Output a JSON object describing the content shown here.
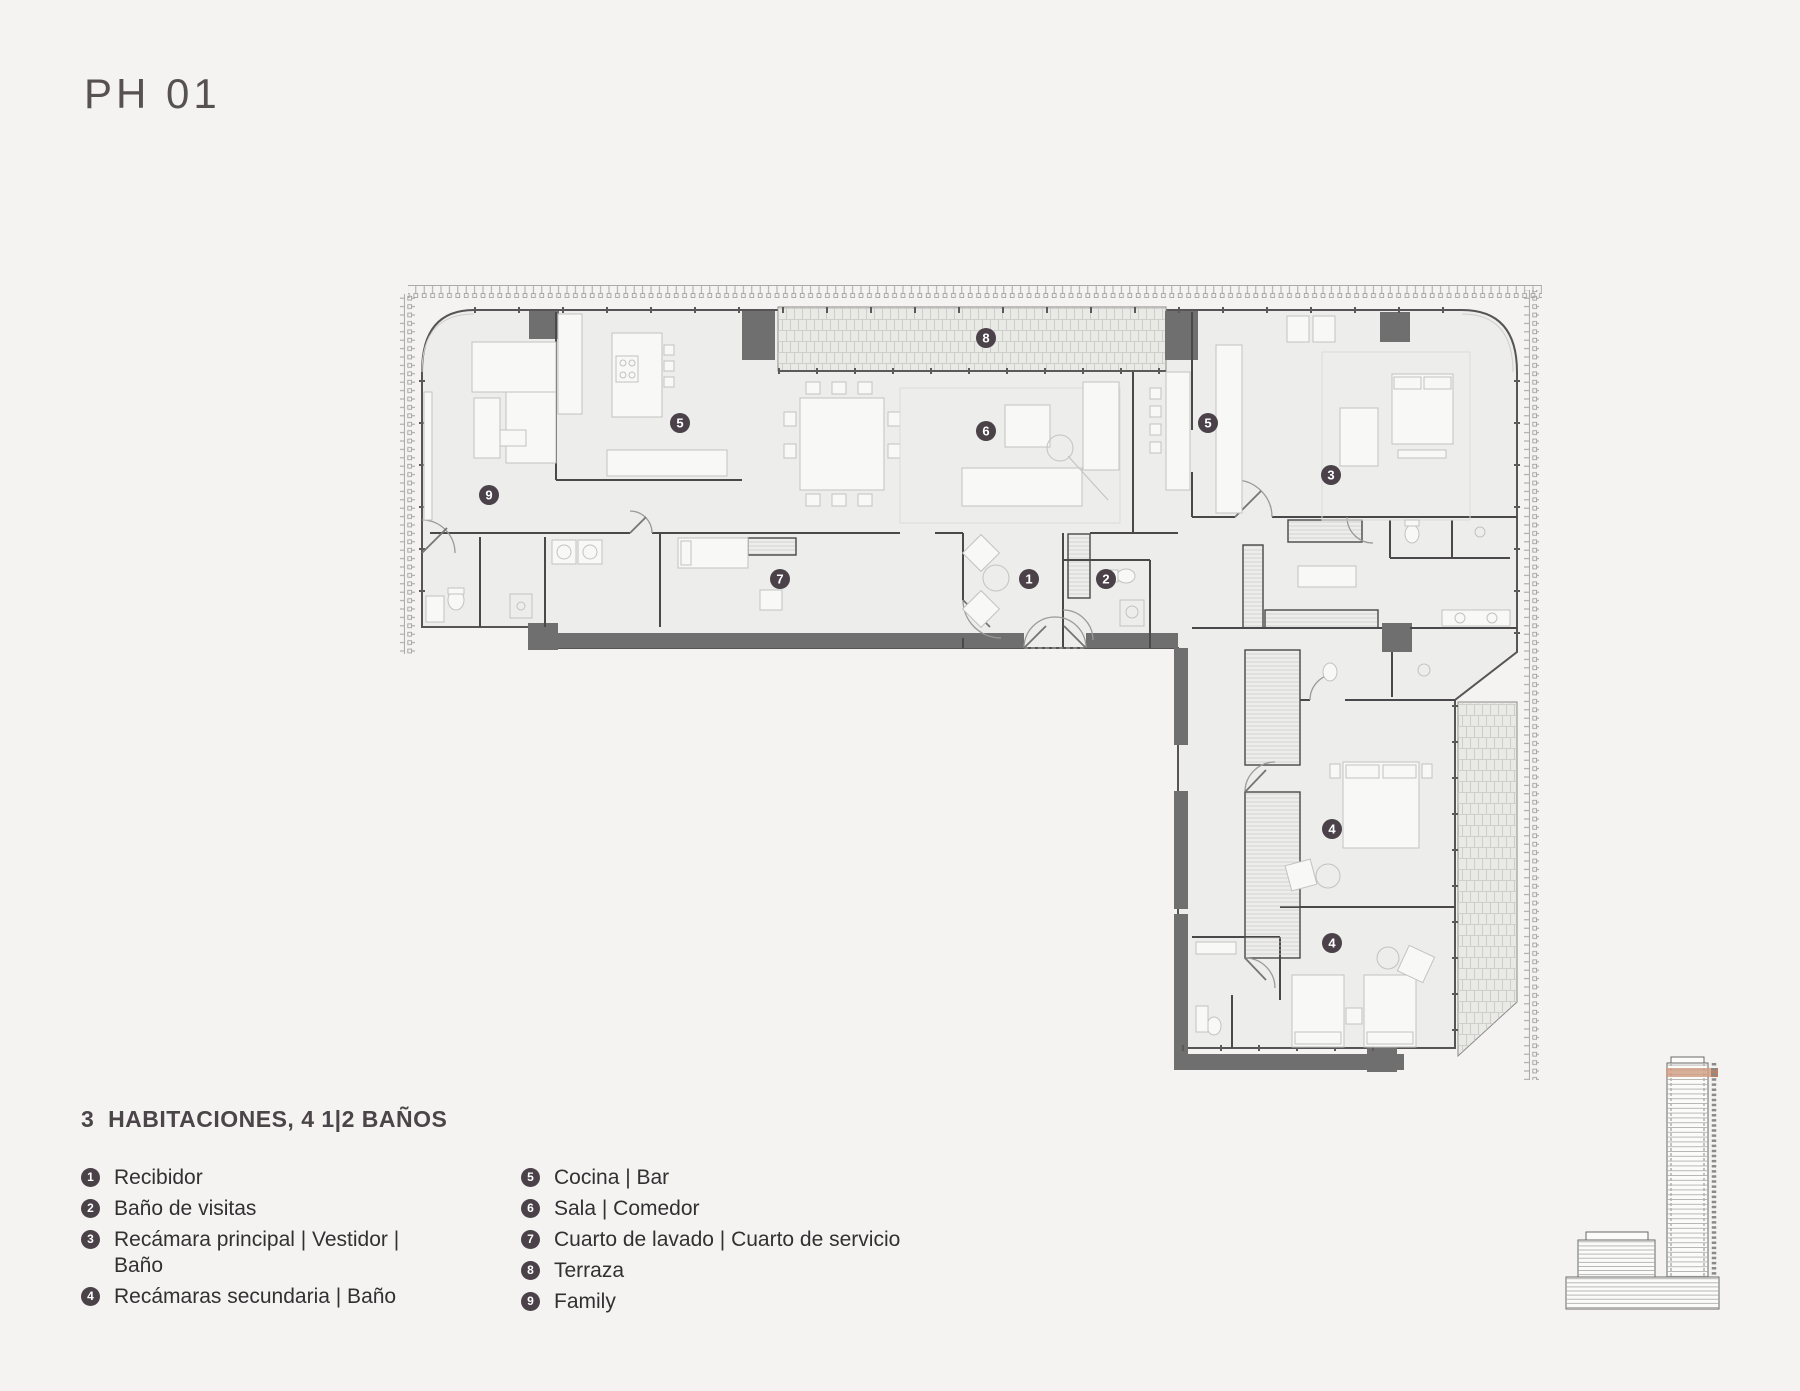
{
  "title": "PH 01",
  "legend": {
    "heading": "3  HABITACIONES, 4 1|2 BAÑOS",
    "columns": [
      {
        "items": [
          {
            "num": "1",
            "label": "Recibidor"
          },
          {
            "num": "2",
            "label": "Baño de visitas"
          },
          {
            "num": "3",
            "label": "Recámara principal | Vestidor | Baño"
          },
          {
            "num": "4",
            "label": "Recámaras secundaria | Baño"
          }
        ]
      },
      {
        "items": [
          {
            "num": "5",
            "label": "Cocina | Bar"
          },
          {
            "num": "6",
            "label": "Sala | Comedor"
          },
          {
            "num": "7",
            "label": "Cuarto de lavado | Cuarto de servicio"
          },
          {
            "num": "8",
            "label": "Terraza"
          },
          {
            "num": "9",
            "label": "Family"
          }
        ]
      }
    ]
  },
  "plan": {
    "markers": [
      {
        "label": "1",
        "room": "Recibidor"
      },
      {
        "label": "2",
        "room": "Baño de visitas"
      },
      {
        "label": "3",
        "room": "Recámara principal"
      },
      {
        "label": "4",
        "room": "Recámara secundaria"
      },
      {
        "label": "4",
        "room": "Recámara secundaria"
      },
      {
        "label": "5",
        "room": "Cocina | Bar"
      },
      {
        "label": "5",
        "room": "Cocina | Bar"
      },
      {
        "label": "6",
        "room": "Sala | Comedor"
      },
      {
        "label": "7",
        "room": "Cuarto de lavado"
      },
      {
        "label": "8",
        "room": "Terraza"
      },
      {
        "label": "9",
        "room": "Family"
      }
    ]
  },
  "colors": {
    "background": "#f4f3f1",
    "floor_fill": "#ededeb",
    "wall_dark": "#4a484a",
    "structure_gray": "#6f6f6f",
    "marker": "#4a4149",
    "legend_bullet": "#4a4149",
    "highlight_floor": "#cf9d82",
    "highlight_floor_dark": "#b97f63",
    "brick": "#e9e9e6"
  }
}
